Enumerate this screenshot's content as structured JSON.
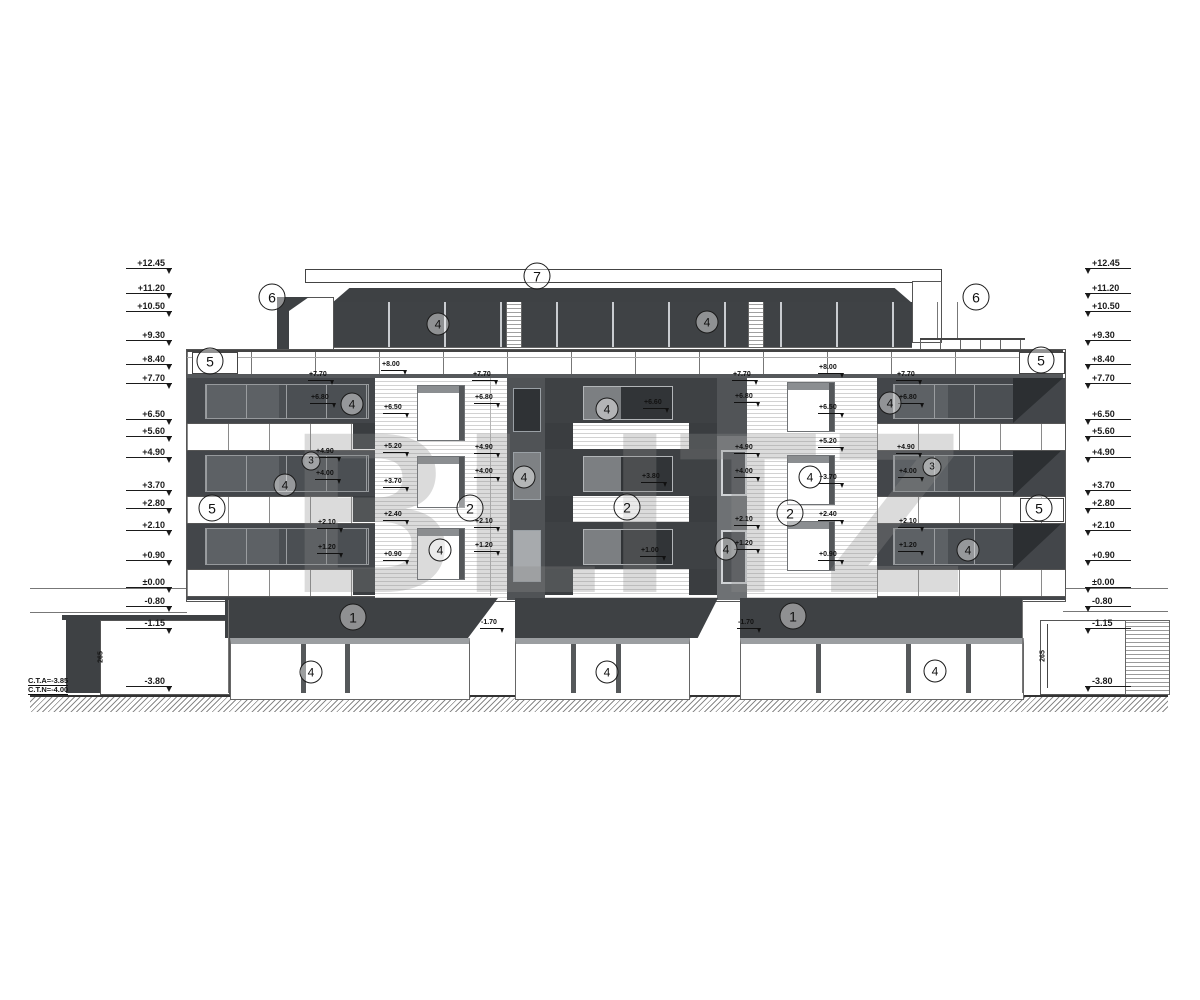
{
  "title": "building-front-elevation",
  "watermark": {
    "text": "BLITZ"
  },
  "notes": {
    "cta": "C.T.A=-3.85",
    "ctn": "C.T.N=-4.00"
  },
  "levels_left": [
    {
      "t": "+12.45",
      "x": 126,
      "y": 269
    },
    {
      "t": "+11.20",
      "x": 126,
      "y": 294
    },
    {
      "t": "+10.50",
      "x": 126,
      "y": 312
    },
    {
      "t": "+9.30",
      "x": 126,
      "y": 341
    },
    {
      "t": "+8.40",
      "x": 126,
      "y": 365
    },
    {
      "t": "+7.70",
      "x": 126,
      "y": 384
    },
    {
      "t": "+6.50",
      "x": 126,
      "y": 420
    },
    {
      "t": "+5.60",
      "x": 126,
      "y": 437
    },
    {
      "t": "+4.90",
      "x": 126,
      "y": 458
    },
    {
      "t": "+3.70",
      "x": 126,
      "y": 491
    },
    {
      "t": "+2.80",
      "x": 126,
      "y": 509
    },
    {
      "t": "+2.10",
      "x": 126,
      "y": 531
    },
    {
      "t": "+0.90",
      "x": 126,
      "y": 561
    },
    {
      "t": "±0.00",
      "x": 126,
      "y": 588
    },
    {
      "t": "-0.80",
      "x": 126,
      "y": 607
    },
    {
      "t": "-1.15",
      "x": 126,
      "y": 629
    },
    {
      "t": "-3.80",
      "x": 126,
      "y": 687
    }
  ],
  "levels_right": [
    {
      "t": "+12.45",
      "x": 1085,
      "y": 269
    },
    {
      "t": "+11.20",
      "x": 1085,
      "y": 294
    },
    {
      "t": "+10.50",
      "x": 1085,
      "y": 312
    },
    {
      "t": "+9.30",
      "x": 1085,
      "y": 341
    },
    {
      "t": "+8.40",
      "x": 1085,
      "y": 365
    },
    {
      "t": "+7.70",
      "x": 1085,
      "y": 384
    },
    {
      "t": "+6.50",
      "x": 1085,
      "y": 420
    },
    {
      "t": "+5.60",
      "x": 1085,
      "y": 437
    },
    {
      "t": "+4.90",
      "x": 1085,
      "y": 458
    },
    {
      "t": "+3.70",
      "x": 1085,
      "y": 491
    },
    {
      "t": "+2.80",
      "x": 1085,
      "y": 509
    },
    {
      "t": "+2.10",
      "x": 1085,
      "y": 531
    },
    {
      "t": "+0.90",
      "x": 1085,
      "y": 561
    },
    {
      "t": "±0.00",
      "x": 1085,
      "y": 588
    },
    {
      "t": "-0.80",
      "x": 1085,
      "y": 607
    },
    {
      "t": "-1.15",
      "x": 1085,
      "y": 629
    },
    {
      "t": "-3.80",
      "x": 1085,
      "y": 687
    }
  ],
  "facade_labels": [
    {
      "t": "+7.70",
      "x": 308,
      "y": 381
    },
    {
      "t": "+6.80",
      "x": 310,
      "y": 404
    },
    {
      "t": "+4.90",
      "x": 315,
      "y": 458
    },
    {
      "t": "+4.00",
      "x": 315,
      "y": 480
    },
    {
      "t": "+2.10",
      "x": 317,
      "y": 529
    },
    {
      "t": "+1.20",
      "x": 317,
      "y": 554
    },
    {
      "t": "+8.00",
      "x": 381,
      "y": 371
    },
    {
      "t": "+6.50",
      "x": 383,
      "y": 414
    },
    {
      "t": "+5.20",
      "x": 383,
      "y": 453
    },
    {
      "t": "+3.70",
      "x": 383,
      "y": 488
    },
    {
      "t": "+2.40",
      "x": 383,
      "y": 521
    },
    {
      "t": "+0.90",
      "x": 383,
      "y": 561
    },
    {
      "t": "+7.70",
      "x": 472,
      "y": 381
    },
    {
      "t": "+6.80",
      "x": 474,
      "y": 404
    },
    {
      "t": "+4.90",
      "x": 474,
      "y": 454
    },
    {
      "t": "+4.00",
      "x": 474,
      "y": 478
    },
    {
      "t": "+2.10",
      "x": 474,
      "y": 528
    },
    {
      "t": "+1.20",
      "x": 474,
      "y": 552
    },
    {
      "t": "+6.60",
      "x": 643,
      "y": 409
    },
    {
      "t": "+3.80",
      "x": 641,
      "y": 483
    },
    {
      "t": "+1.00",
      "x": 640,
      "y": 557
    },
    {
      "t": "+7.70",
      "x": 732,
      "y": 381
    },
    {
      "t": "+6.80",
      "x": 734,
      "y": 403
    },
    {
      "t": "+4.90",
      "x": 734,
      "y": 454
    },
    {
      "t": "+4.00",
      "x": 734,
      "y": 478
    },
    {
      "t": "+2.10",
      "x": 734,
      "y": 526
    },
    {
      "t": "+1.20",
      "x": 734,
      "y": 550
    },
    {
      "t": "+8.00",
      "x": 818,
      "y": 374
    },
    {
      "t": "+6.50",
      "x": 818,
      "y": 414
    },
    {
      "t": "+5.20",
      "x": 818,
      "y": 448
    },
    {
      "t": "+3.70",
      "x": 818,
      "y": 484
    },
    {
      "t": "+2.40",
      "x": 818,
      "y": 521
    },
    {
      "t": "+0.90",
      "x": 818,
      "y": 561
    },
    {
      "t": "+7.70",
      "x": 896,
      "y": 381
    },
    {
      "t": "+6.80",
      "x": 898,
      "y": 404
    },
    {
      "t": "+4.90",
      "x": 896,
      "y": 454
    },
    {
      "t": "+4.00",
      "x": 898,
      "y": 478
    },
    {
      "t": "+2.10",
      "x": 898,
      "y": 528
    },
    {
      "t": "+1.20",
      "x": 898,
      "y": 552
    },
    {
      "t": "-1.70",
      "x": 480,
      "y": 629
    },
    {
      "t": "-1.70",
      "x": 737,
      "y": 629
    }
  ],
  "dims": [
    {
      "t": "265",
      "x": 101,
      "y": 657
    },
    {
      "t": "265",
      "x": 1043,
      "y": 656
    }
  ],
  "callouts": [
    {
      "n": "7",
      "x": 537,
      "y": 276,
      "cls": "b"
    },
    {
      "n": "6",
      "x": 272,
      "y": 297,
      "cls": "b"
    },
    {
      "n": "6",
      "x": 976,
      "y": 297,
      "cls": "b"
    },
    {
      "n": "5",
      "x": 210,
      "y": 361,
      "cls": "b"
    },
    {
      "n": "5",
      "x": 1041,
      "y": 360,
      "cls": "b"
    },
    {
      "n": "5",
      "x": 212,
      "y": 508,
      "cls": "b"
    },
    {
      "n": "5",
      "x": 1039,
      "y": 508,
      "cls": "b"
    },
    {
      "n": "4",
      "x": 438,
      "y": 324,
      "cls": "m"
    },
    {
      "n": "4",
      "x": 707,
      "y": 322,
      "cls": "m"
    },
    {
      "n": "4",
      "x": 352,
      "y": 404,
      "cls": "m"
    },
    {
      "n": "4",
      "x": 285,
      "y": 485,
      "cls": "m"
    },
    {
      "n": "3",
      "x": 311,
      "y": 461,
      "cls": "s"
    },
    {
      "n": "3",
      "x": 932,
      "y": 467,
      "cls": "s"
    },
    {
      "n": "4",
      "x": 440,
      "y": 550,
      "cls": "m"
    },
    {
      "n": "4",
      "x": 524,
      "y": 477,
      "cls": "m"
    },
    {
      "n": "4",
      "x": 607,
      "y": 409,
      "cls": "m"
    },
    {
      "n": "2",
      "x": 470,
      "y": 508,
      "cls": "b"
    },
    {
      "n": "2",
      "x": 627,
      "y": 507,
      "cls": "b"
    },
    {
      "n": "2",
      "x": 790,
      "y": 513,
      "cls": "b"
    },
    {
      "n": "4",
      "x": 726,
      "y": 549,
      "cls": "m"
    },
    {
      "n": "4",
      "x": 810,
      "y": 477,
      "cls": "m"
    },
    {
      "n": "4",
      "x": 890,
      "y": 403,
      "cls": "m"
    },
    {
      "n": "4",
      "x": 968,
      "y": 550,
      "cls": "m"
    },
    {
      "n": "1",
      "x": 353,
      "y": 617,
      "cls": "b"
    },
    {
      "n": "1",
      "x": 793,
      "y": 616,
      "cls": "b"
    },
    {
      "n": "4",
      "x": 311,
      "y": 672,
      "cls": "m"
    },
    {
      "n": "4",
      "x": 607,
      "y": 672,
      "cls": "m"
    },
    {
      "n": "4",
      "x": 935,
      "y": 671,
      "cls": "m"
    }
  ]
}
